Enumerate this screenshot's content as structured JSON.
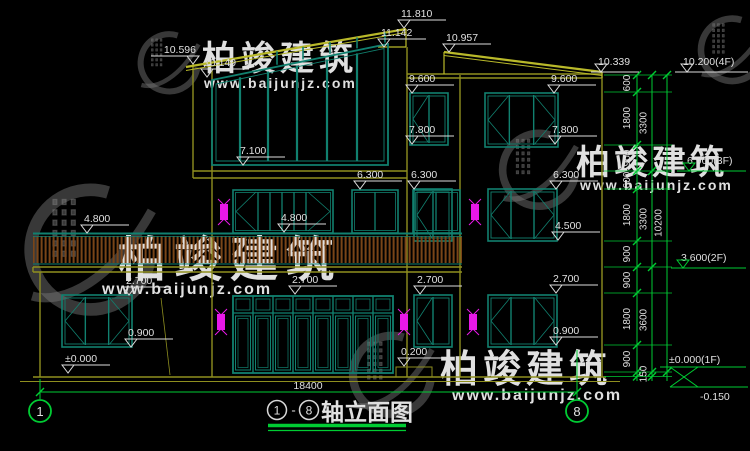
{
  "colors": {
    "background": "#000000",
    "frame_teal": "#11806f",
    "wall_olive": "#8f8f1f",
    "roof_yellow": "#b9b92a",
    "dim_green": "#00cc33",
    "text_white": "#e0e0e0",
    "lamp_magenta": "#e818e8",
    "railing_brown": "#7a4518",
    "watermark_gray": "#7d7d7d",
    "watermark_red": "#9a2d2d"
  },
  "watermark": {
    "brand": "柏竣建筑",
    "url": "www.baijunjz.com"
  },
  "title": {
    "axis_start": "1",
    "separator": "-",
    "axis_end": "8",
    "name": "轴立面图"
  },
  "axes": {
    "left": "1",
    "right": "8"
  },
  "dimensions": {
    "overall_width": "18400"
  },
  "right_dim_column": {
    "col1": [
      "600",
      "1800",
      "900",
      "600",
      "1800",
      "900",
      "900",
      "1800",
      "900"
    ],
    "col2": [
      "3300",
      "3300",
      "3600",
      "150"
    ],
    "col3": [
      "10200"
    ]
  },
  "floor_levels": [
    "10.339",
    "10.200(4F)",
    "6.900(3F)",
    "3.600(2F)",
    "±0.000(1F)",
    "-0.150"
  ],
  "level_markers": [
    {
      "v": "10.596",
      "x": 193,
      "y": 64,
      "d": -1
    },
    {
      "v": "10.149",
      "x": 207,
      "y": 77,
      "d": 1
    },
    {
      "v": "11.810",
      "x": 404,
      "y": 28,
      "d": 1
    },
    {
      "v": "11.142",
      "x": 384,
      "y": 47,
      "d": 1
    },
    {
      "v": "10.957",
      "x": 449,
      "y": 52,
      "d": 1
    },
    {
      "v": "9.600",
      "x": 412,
      "y": 93,
      "d": 1
    },
    {
      "v": "7.800",
      "x": 412,
      "y": 144,
      "d": 1
    },
    {
      "v": "6.300",
      "x": 414,
      "y": 189,
      "d": 1
    },
    {
      "v": "9.600",
      "x": 554,
      "y": 93,
      "d": 1
    },
    {
      "v": "7.800",
      "x": 555,
      "y": 144,
      "d": 1
    },
    {
      "v": "6.300",
      "x": 556,
      "y": 189,
      "d": 1
    },
    {
      "v": "4.500",
      "x": 558,
      "y": 240,
      "d": 1
    },
    {
      "v": "2.700",
      "x": 556,
      "y": 293,
      "d": 1
    },
    {
      "v": "0.900",
      "x": 556,
      "y": 345,
      "d": 1
    },
    {
      "v": "7.100",
      "x": 243,
      "y": 165,
      "d": 1
    },
    {
      "v": "6.300",
      "x": 360,
      "y": 189,
      "d": 1
    },
    {
      "v": "4.800",
      "x": 87,
      "y": 233,
      "d": 1
    },
    {
      "v": "4.800",
      "x": 284,
      "y": 232,
      "d": 1
    },
    {
      "v": "2.700",
      "x": 129,
      "y": 295,
      "d": 1
    },
    {
      "v": "2.700",
      "x": 295,
      "y": 294,
      "d": 1
    },
    {
      "v": "2.700",
      "x": 420,
      "y": 294,
      "d": 1
    },
    {
      "v": "0.900",
      "x": 131,
      "y": 347,
      "d": 1
    },
    {
      "v": "±0.000",
      "x": 68,
      "y": 373,
      "d": 1
    },
    {
      "v": "0.200",
      "x": 404,
      "y": 366,
      "d": 1
    }
  ]
}
